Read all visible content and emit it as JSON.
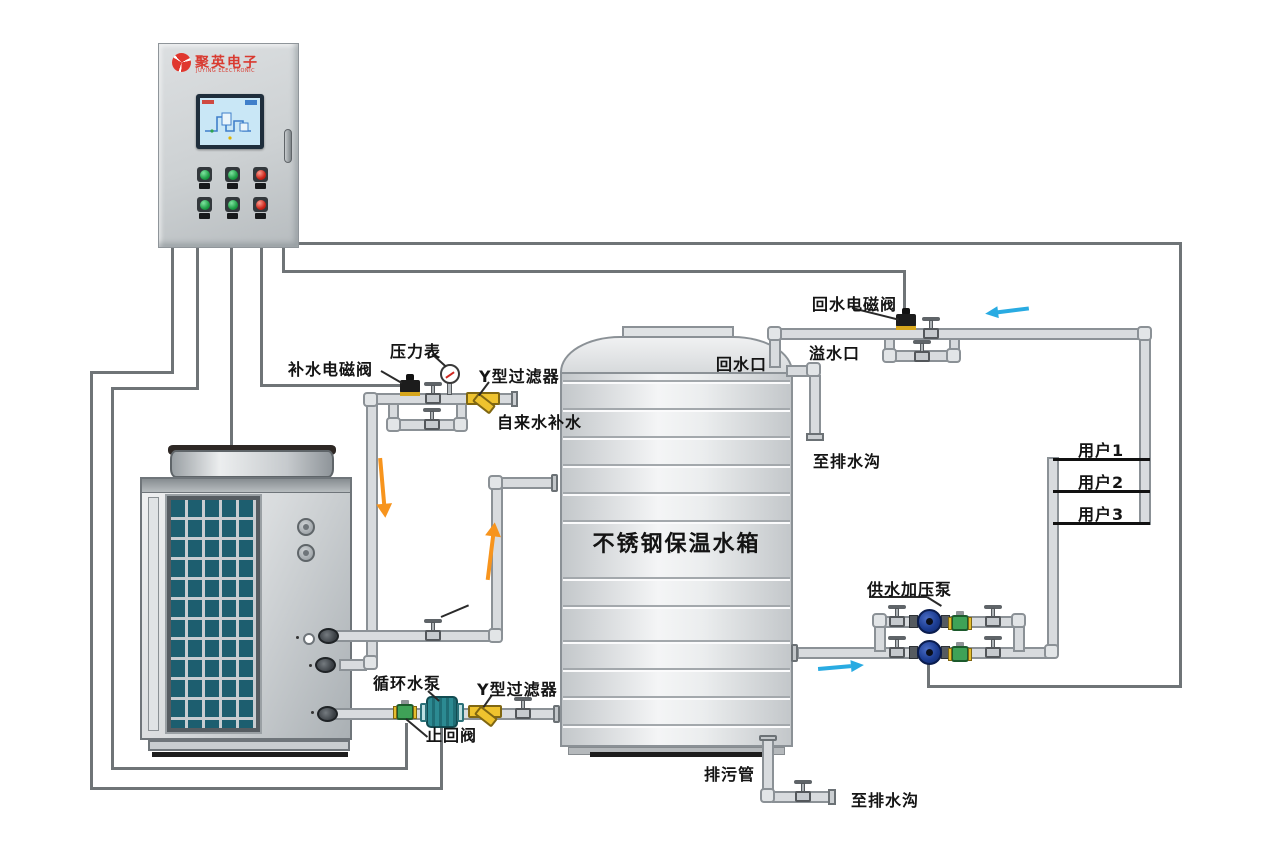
{
  "panel": {
    "brand": "聚英电子",
    "brand_sub": "JUYING ELECTRONIC"
  },
  "labels": {
    "makeup_solenoid": "补水电磁阀",
    "pressure_gauge": "压力表",
    "y_filter": "Y型过滤器",
    "tap_water_makeup": "自来水补水",
    "return_solenoid": "回水电磁阀",
    "overflow_port": "溢水口",
    "return_port": "回水口",
    "to_drain": "至排水沟",
    "tank_name": "不锈钢保温水箱",
    "booster_pump": "供水加压泵",
    "circulation_pump": "循环水泵",
    "check_valve": "止回阀",
    "drain_pipe": "排污管",
    "users": [
      "用户1",
      "用户2",
      "用户3"
    ]
  },
  "colors": {
    "brand_red": "#d93a30",
    "pipe_gray": "#d8dbde",
    "wire_gray": "#6f7477",
    "arrow_blue": "#29abe2",
    "arrow_orange": "#f7941d",
    "filter_yellow": "#efc32e",
    "check_green": "#3fa257",
    "pump_blue": "#1c3d92",
    "pump_teal": "#2c8a92",
    "coil_teal": "#1d5e6f"
  }
}
